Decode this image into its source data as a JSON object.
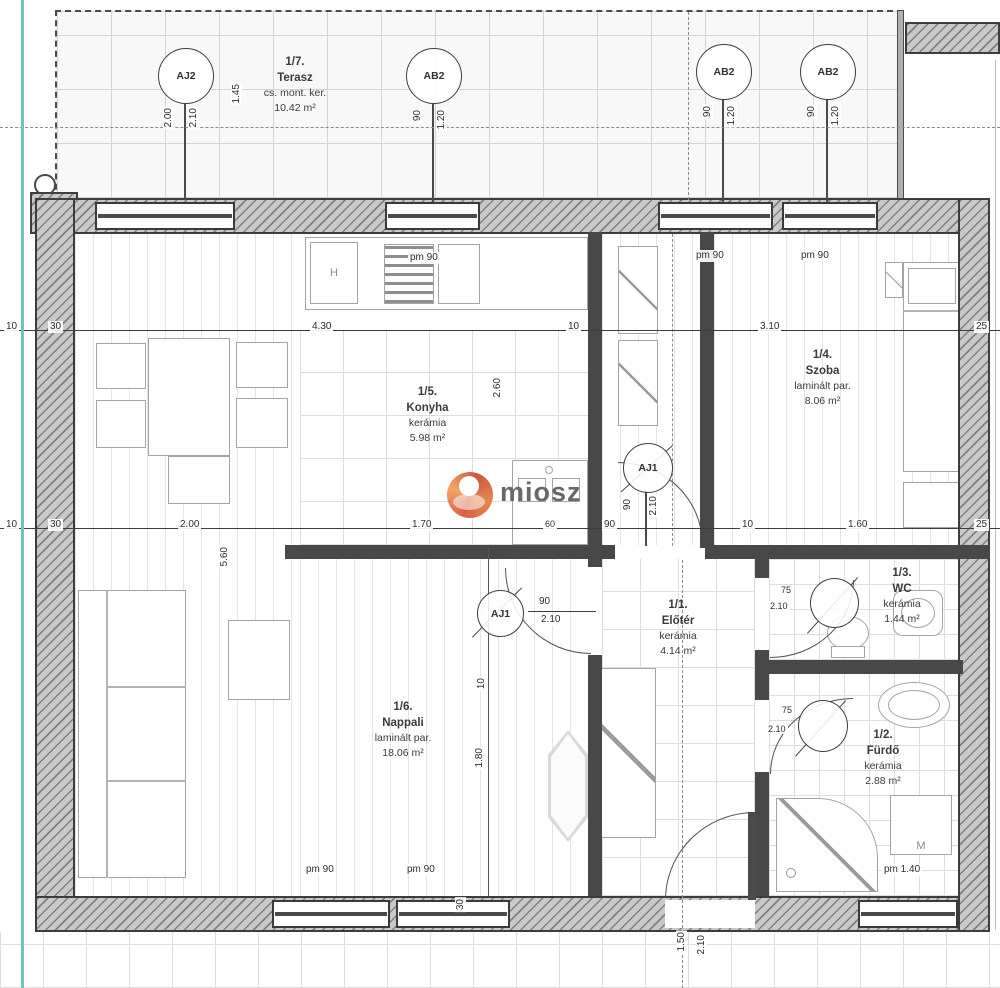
{
  "watermark": {
    "text": "miosz"
  },
  "terrace": {
    "id": "1/7.",
    "name": "Terasz",
    "material": "cs. mont. ker.",
    "area": "10.42 m²"
  },
  "rooms": {
    "konyha": {
      "id": "1/5.",
      "name": "Konyha",
      "material": "kerámia",
      "area": "5.98 m²"
    },
    "szoba": {
      "id": "1/4.",
      "name": "Szoba",
      "material": "laminált par.",
      "area": "8.06 m²"
    },
    "eloter": {
      "id": "1/1.",
      "name": "Előtér",
      "material": "kerámia",
      "area": "4.14 m²"
    },
    "wc": {
      "id": "1/3.",
      "name": "WC",
      "material": "kerámia",
      "area": "1.44 m²"
    },
    "nappali": {
      "id": "1/6.",
      "name": "Nappali",
      "material": "laminált par.",
      "area": "18.06 m²"
    },
    "furdo": {
      "id": "1/2.",
      "name": "Fürdő",
      "material": "kerámia",
      "area": "2.88 m²"
    }
  },
  "openings": {
    "aj2": {
      "label": "AJ2",
      "w": "2.00",
      "h": "2.10"
    },
    "ab2_1": {
      "label": "AB2",
      "w": "90",
      "h": "1.20"
    },
    "ab2_2": {
      "label": "AB2",
      "w": "90",
      "h": "1.20"
    },
    "ab2_3": {
      "label": "AB2",
      "w": "90",
      "h": "1.20"
    },
    "aj1_szoba": {
      "label": "AJ1",
      "w": "90",
      "h": "2.10"
    },
    "aj1_nappali": {
      "label": "AJ1",
      "w": "90",
      "h": "2.10"
    },
    "wc_door": {
      "w": "75",
      "h": "2.10"
    },
    "furdo_door": {
      "w": "75",
      "h": "2.10"
    }
  },
  "window_tags": {
    "pm90": "pm 90",
    "pm140": "pm 1.40"
  },
  "appliances": {
    "fridge": "H",
    "washer": "M"
  },
  "dim_rows": {
    "r1": {
      "d10a": "10",
      "d30": "30",
      "d430": "4.30",
      "d10b": "10",
      "d310": "3.10",
      "d25": "25"
    },
    "r2": {
      "d10a": "10",
      "d30": "30",
      "d200": "2.00",
      "d170": "1.70",
      "d60": "60",
      "d90": "90",
      "d10b": "10",
      "d160": "1.60",
      "d25": "25"
    }
  },
  "vdims": {
    "v145": "1.45",
    "v560": "5.60",
    "v260": "2.60",
    "v10": "10",
    "v180": "1.80",
    "v30": "30",
    "v150": "1.50",
    "v210": "2.10"
  },
  "colors": {
    "wall": "#3d3d3d",
    "teal": "#6fc6b7",
    "logo_orange": "#e2502d"
  }
}
